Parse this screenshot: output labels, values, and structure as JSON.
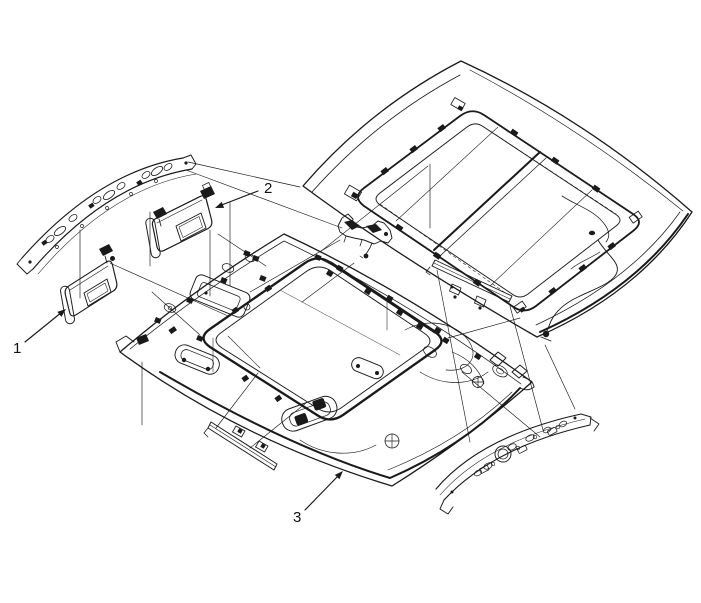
{
  "figure": {
    "kind": "exploded-parts-diagram",
    "background_color": "#ffffff",
    "line_color": "#1a1a1a"
  },
  "callouts": [
    {
      "label": "1",
      "target": "sun-visor-left"
    },
    {
      "label": "2",
      "target": "sun-visor-right"
    },
    {
      "label": "3",
      "target": "headliner"
    }
  ]
}
